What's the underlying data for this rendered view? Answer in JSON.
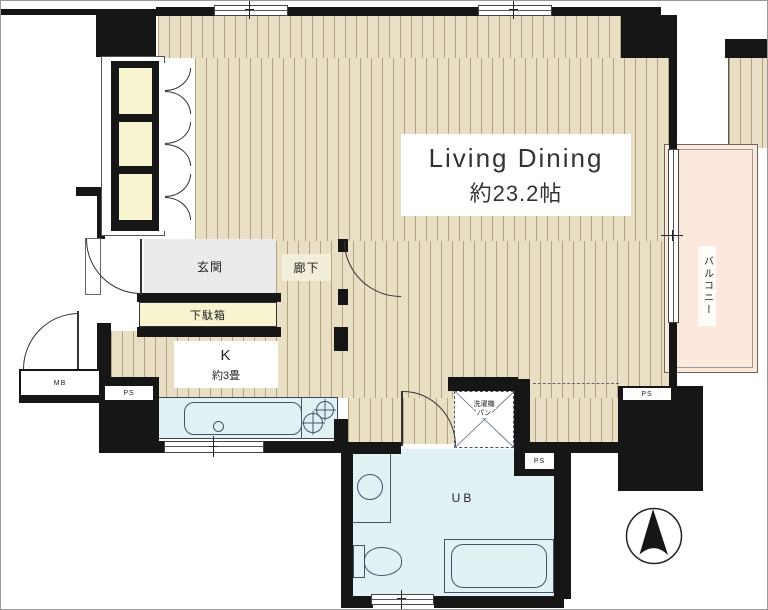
{
  "rooms": {
    "living_dining": {
      "name": "Living Dining",
      "size": "約23.2帖"
    },
    "kitchen": {
      "name": "K",
      "size": "約3畳"
    },
    "entrance": "玄関",
    "hallway": "廊下",
    "shoe_cabinet": "下駄箱",
    "balcony": "バルコニー",
    "unit_bath": "UB"
  },
  "fixtures": {
    "washer_pan": {
      "line1": "洗濯機",
      "line2": "パン"
    }
  },
  "utilities": {
    "pipe_space": "PS",
    "meter_box": "MB"
  },
  "colors": {
    "wall": "#161616",
    "flooring": "#e9dfc4",
    "flooring_stripe": "#b3a17f",
    "water_area": "#e1f2f5",
    "cabinet_yellow": "#f8f4cf",
    "entrance_gray": "#ebebeb",
    "balcony_peach": "#fce9db",
    "cream": "#f2eeda"
  }
}
